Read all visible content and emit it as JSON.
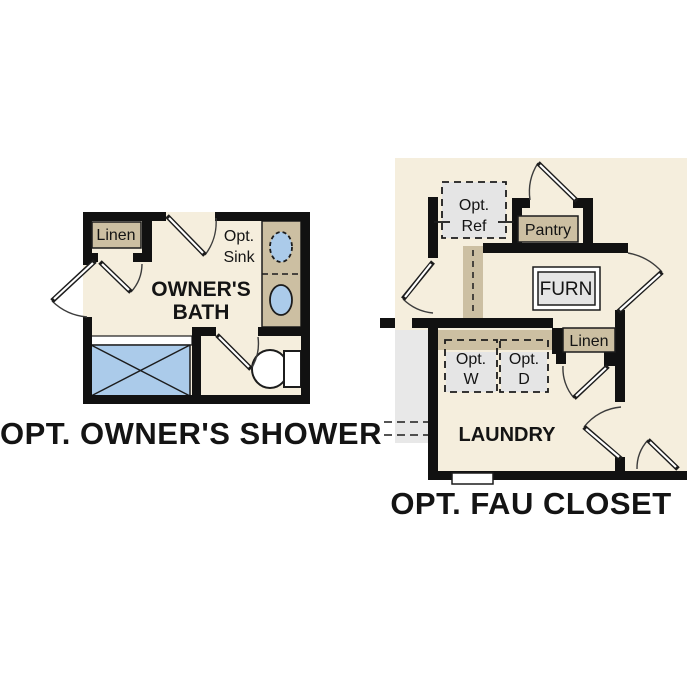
{
  "colors": {
    "canvas": "#ffffff",
    "cream": "#f5eedd",
    "tan": "#ccbfa2",
    "gray_box": "#e5e5e5",
    "gray_area": "#e8e8e8",
    "blue": "#abcbea",
    "wall": "#111111",
    "white": "#ffffff"
  },
  "left_plan": {
    "title": "OPT. OWNER'S SHOWER",
    "labels": {
      "linen": "Linen",
      "opt_sink_1": "Opt.",
      "opt_sink_2": "Sink",
      "room_1": "OWNER'S",
      "room_2": "BATH"
    }
  },
  "right_plan": {
    "title": "OPT. FAU CLOSET",
    "labels": {
      "opt_ref_1": "Opt.",
      "opt_ref_2": "Ref",
      "pantry": "Pantry",
      "furn": "FURN",
      "linen": "Linen",
      "opt_w_1": "Opt.",
      "opt_w_2": "W",
      "opt_d_1": "Opt.",
      "opt_d_2": "D",
      "laundry": "LAUNDRY"
    }
  }
}
